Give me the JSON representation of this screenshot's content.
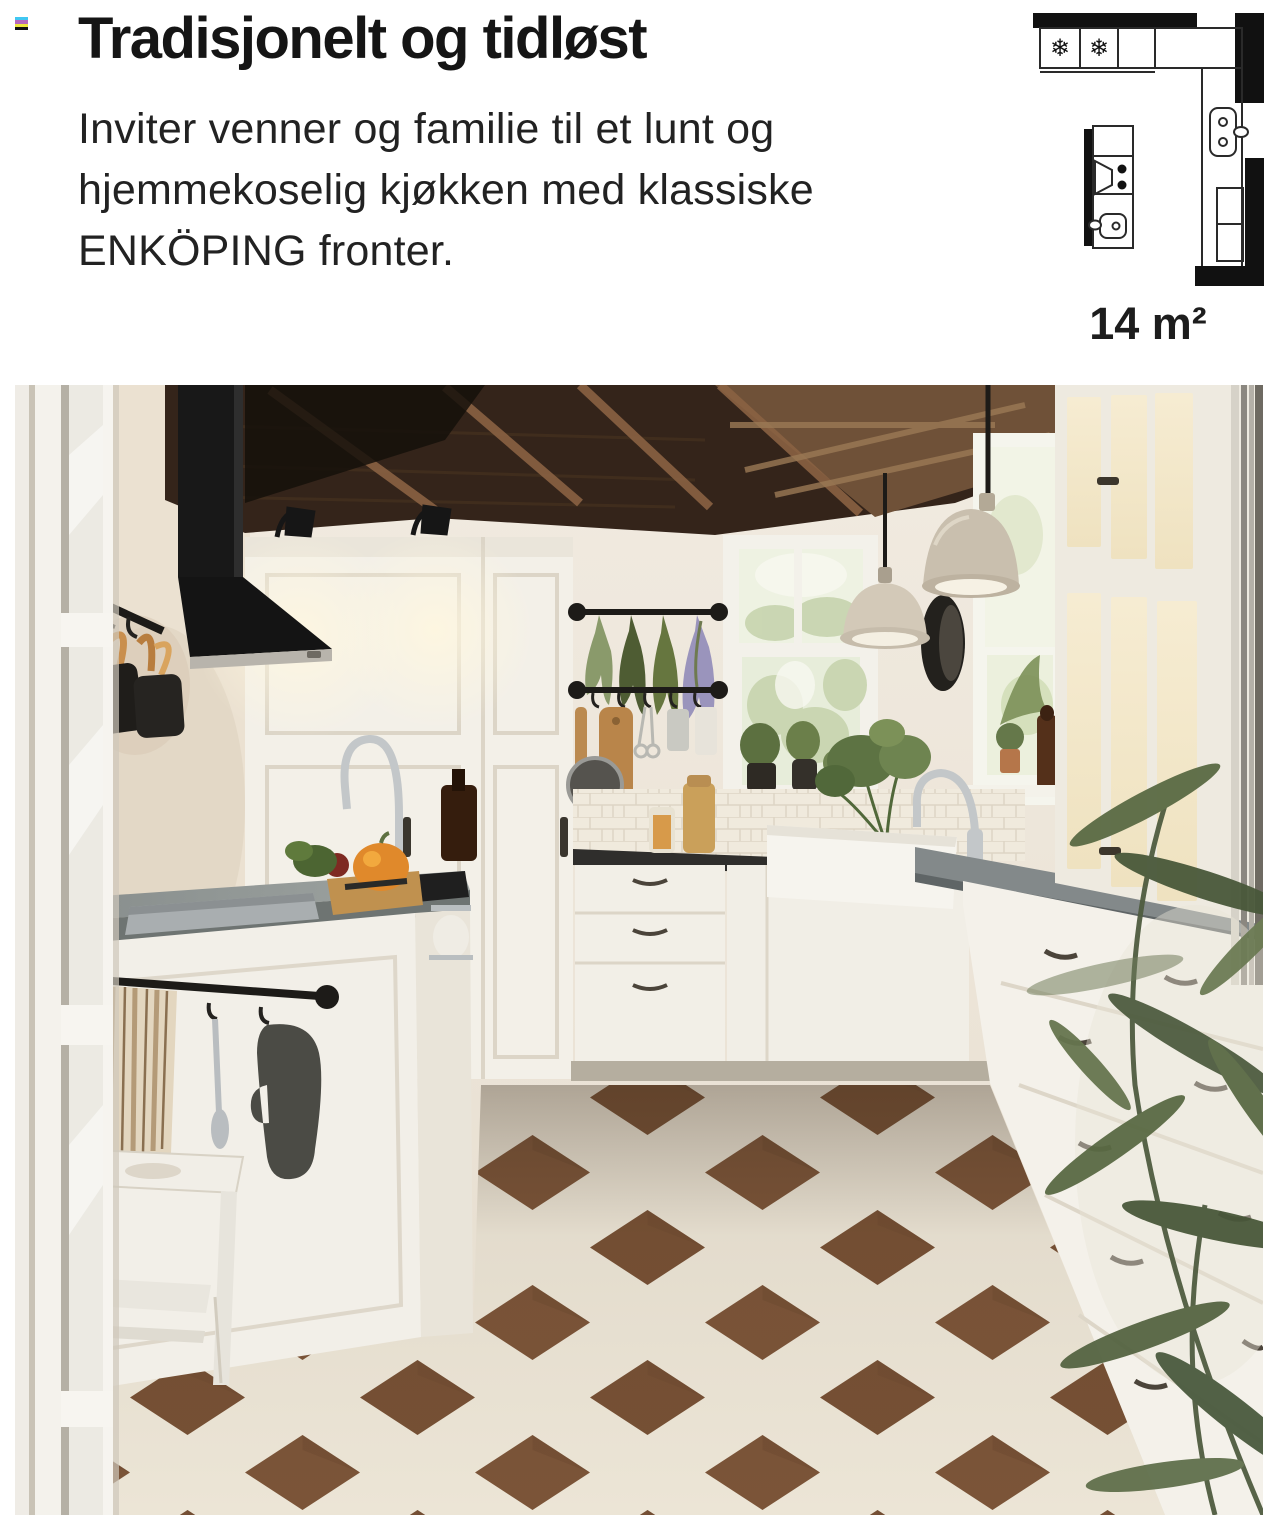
{
  "page": {
    "background_color": "#ffffff"
  },
  "print_mark": {
    "stripe_colors": [
      "#41c7f2",
      "#b669bd",
      "#efe63e",
      "#101010"
    ]
  },
  "intro": {
    "title": "Tradisjonelt og tidløst",
    "body_lines": [
      "Inviter venner og familie til et lunt og",
      "hjemmekoselig kjøkken med klassiske",
      "ENKÖPING fronter."
    ]
  },
  "floorplan": {
    "area_label": "14 m²",
    "snowflake_symbol": "❄",
    "description": "L-shaped kitchen floor plan, 14 square meters, with fridge and freezer, corner counter run with sink and appliance, and a kitchen island with cooktop and small sink"
  },
  "photo": {
    "description": "Traditional white ENKÖPING kitchen: black chimney range hood, dark wood beamed ceiling, white shaker cabinets, hanging herb bunches on black rails, two cream pendant lamps, windows with plants, farmhouse sink, kitchen island with grey top and sink, white step stool, brown and white checkerboard floor, olive plant in the foreground"
  },
  "colors": {
    "accent_black": "#111111",
    "counter_dark": "#2f2e2c",
    "island_top_grey": "#8f9594",
    "cabinet_white": "#f3f0e9",
    "floor_brown": "#7b5438",
    "floor_cream": "#ece5d6",
    "ceiling_wood": "#34241a"
  }
}
